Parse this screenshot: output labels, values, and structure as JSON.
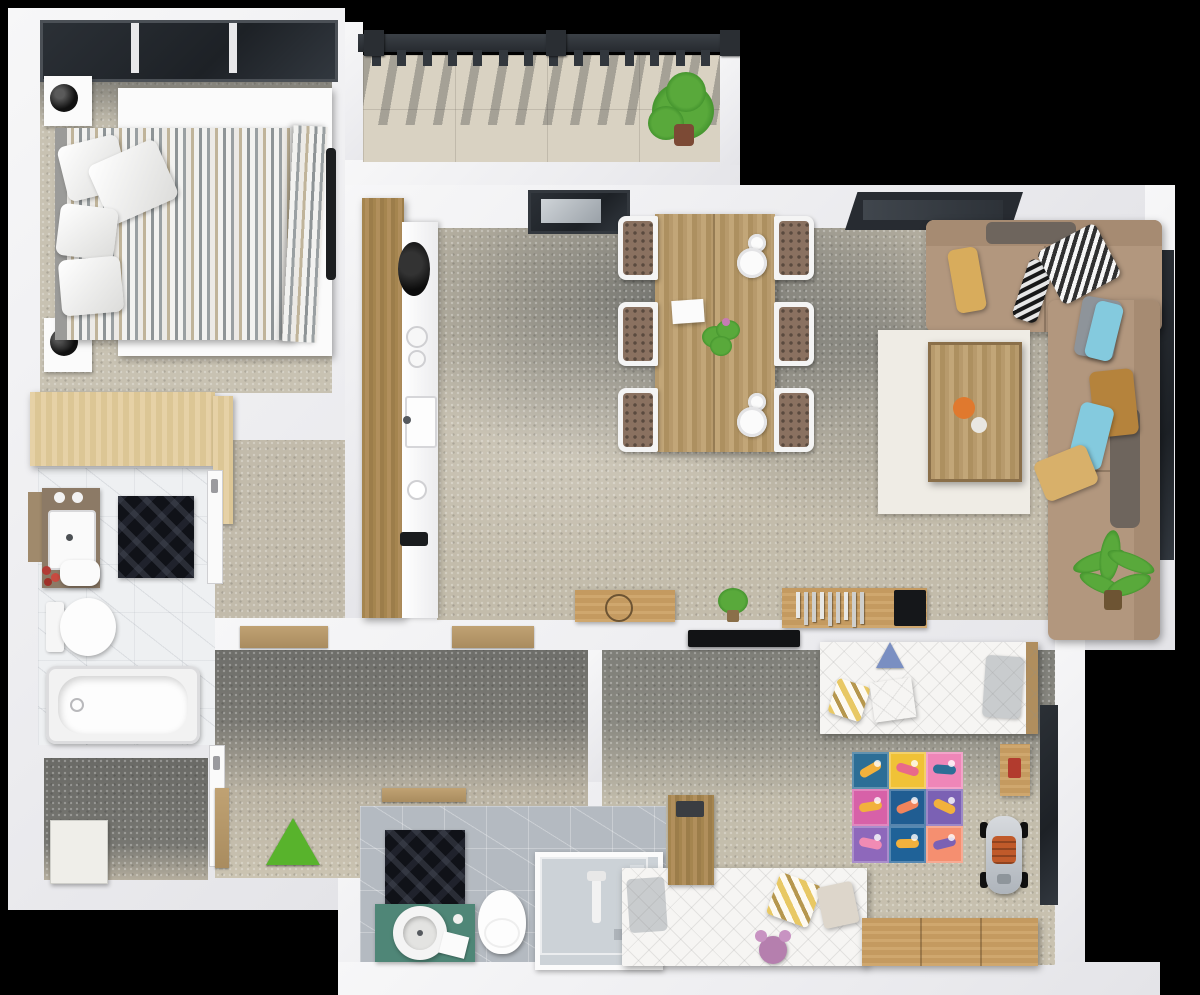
{
  "scene": {
    "type": "apartment-floor-plan-3d-top-view",
    "background_color": "#000000",
    "wall_color": "#f2f2f4",
    "entrance_marker": {
      "shape": "triangle",
      "color": "#58b32c"
    }
  },
  "rooms": {
    "bedroom": {
      "floor_color": "#c8c2b2",
      "items": [
        "double-bed-striped-duvet",
        "headboard",
        "nightstand-left-top",
        "nightstand-left-bottom",
        "black-table-lamps",
        "wardrobe",
        "window-3-pane"
      ],
      "duvet_stripe_colors": [
        "#f2f2f0",
        "#9aa0a2",
        "#c0b49a"
      ],
      "pillows": [
        {
          "x": 62,
          "y": 140,
          "w": 62,
          "h": 56,
          "r": -14
        },
        {
          "x": 96,
          "y": 150,
          "w": 74,
          "h": 64,
          "r": -24
        },
        {
          "x": 58,
          "y": 206,
          "w": 58,
          "h": 52,
          "r": 7
        },
        {
          "x": 60,
          "y": 258,
          "w": 62,
          "h": 56,
          "r": -5
        }
      ]
    },
    "balcony": {
      "floor": "tiled-beige",
      "railing_color": "#32373d",
      "balusters": {
        "count": 14,
        "x0": 372,
        "y": 50,
        "dx": 25.3,
        "w": 9,
        "h": 16
      },
      "posts": [
        364,
        546,
        720
      ],
      "plant": {
        "x": 648,
        "y": 72,
        "color": "#4aa12e"
      }
    },
    "kitchen": {
      "cabinet_wood_color": "#a5854f",
      "counter_color": "#f4f4f4",
      "items": [
        "black-round-hob",
        "burners",
        "sink",
        "black-faucet"
      ]
    },
    "dining": {
      "table": {
        "x": 655,
        "y": 214,
        "w": 120,
        "h": 238,
        "color": "#b79a6c"
      },
      "chairs": [
        {
          "x": 618,
          "y": 216,
          "side": "L"
        },
        {
          "x": 618,
          "y": 302,
          "side": "L"
        },
        {
          "x": 618,
          "y": 388,
          "side": "L"
        },
        {
          "x": 774,
          "y": 216,
          "side": "R"
        },
        {
          "x": 774,
          "y": 302,
          "side": "R"
        },
        {
          "x": 774,
          "y": 388,
          "side": "R"
        }
      ],
      "chair_cushion_color": "#8a7160",
      "plates": [
        {
          "cx": 757,
          "cy": 243,
          "r": 9
        },
        {
          "cx": 752,
          "cy": 263,
          "r": 15
        },
        {
          "cx": 757,
          "cy": 402,
          "r": 9
        },
        {
          "cx": 752,
          "cy": 422,
          "r": 15
        }
      ],
      "decor": [
        "white-paper",
        "green-centerpiece"
      ]
    },
    "living_room": {
      "sofa_color": "#b2977e",
      "armrest_pad_color": "#6e655d",
      "coffee_table": {
        "rug_color": "#efece5",
        "top_color": "#b08e5e",
        "orange_dot": "#e0792e"
      },
      "tv_console": {
        "wood": "#b08e5e",
        "books_count": 9,
        "tv_color": "#15171a"
      },
      "windows": [
        "top-tilted-window",
        "right-wall-window"
      ],
      "pillows": [
        {
          "x": 952,
          "y": 248,
          "w": 30,
          "h": 64,
          "c": "#d8ac5c",
          "r": -10,
          "p": ""
        },
        {
          "x": 1020,
          "y": 260,
          "w": 26,
          "h": 62,
          "c": "#2e3134",
          "r": 18,
          "p": "bw"
        },
        {
          "x": 1046,
          "y": 234,
          "w": 66,
          "h": 60,
          "c": "#cfd2d4",
          "r": -28,
          "p": "bw"
        },
        {
          "x": 1078,
          "y": 298,
          "w": 40,
          "h": 60,
          "c": "#8e949a",
          "r": 10,
          "p": ""
        },
        {
          "x": 1090,
          "y": 302,
          "w": 28,
          "h": 58,
          "c": "#84cade",
          "r": 14,
          "p": ""
        },
        {
          "x": 1092,
          "y": 370,
          "w": 44,
          "h": 66,
          "c": "#b5833c",
          "r": -6,
          "p": ""
        },
        {
          "x": 1074,
          "y": 404,
          "w": 34,
          "h": 64,
          "c": "#84cade",
          "r": 14,
          "p": ""
        },
        {
          "x": 1038,
          "y": 452,
          "w": 56,
          "h": 42,
          "c": "#d8b06a",
          "r": -22,
          "p": ""
        }
      ],
      "plant_color": "#3f8f2b"
    },
    "bathroom_main": {
      "floor": "white-marble",
      "items": [
        "vanity-sink",
        "towels",
        "red-candles",
        "dark-geometric-mat",
        "toilet",
        "bathtub",
        "wood-shelf"
      ],
      "vanity_wood": "#8c7a66"
    },
    "bathroom_second": {
      "floor": "gray-marble",
      "vanity_color": "#4f8677",
      "items": [
        "round-vessel-sink",
        "toilet",
        "shower-cabin",
        "dark-geometric-mat",
        "door-sill"
      ]
    },
    "hallway": {
      "floor": "concrete-shadowed",
      "items": [
        "door-sills",
        "entrance-triangle"
      ]
    },
    "storage": {
      "items": [
        "white-cabinet"
      ]
    },
    "kids_room": {
      "items": [
        "single-bed",
        "teepee-toy",
        "play-mat",
        "side-table",
        "ride-on-car",
        "daybed-sofa",
        "plush-toy",
        "dresser",
        "desk",
        "wall-tv",
        "window"
      ],
      "play_mat": {
        "x": 852,
        "y": 752,
        "tile": 37,
        "tiles": [
          {
            "c": "#2c6e96",
            "d": "#f2b13c"
          },
          {
            "c": "#f0c237",
            "d": "#e86a8a"
          },
          {
            "c": "#ef86b8",
            "d": "#2d6e96"
          },
          {
            "c": "#d761a8",
            "d": "#f2b13c"
          },
          {
            "c": "#205d92",
            "d": "#f0845c"
          },
          {
            "c": "#7b61b4",
            "d": "#f2b13c"
          },
          {
            "c": "#8e68bb",
            "d": "#f08bb4"
          },
          {
            "c": "#1f6298",
            "d": "#f2b13c"
          },
          {
            "c": "#f58f70",
            "d": "#7b61b4"
          }
        ]
      },
      "car_seat_color": "#c05a2a",
      "plush_color": "#b57fae"
    }
  }
}
